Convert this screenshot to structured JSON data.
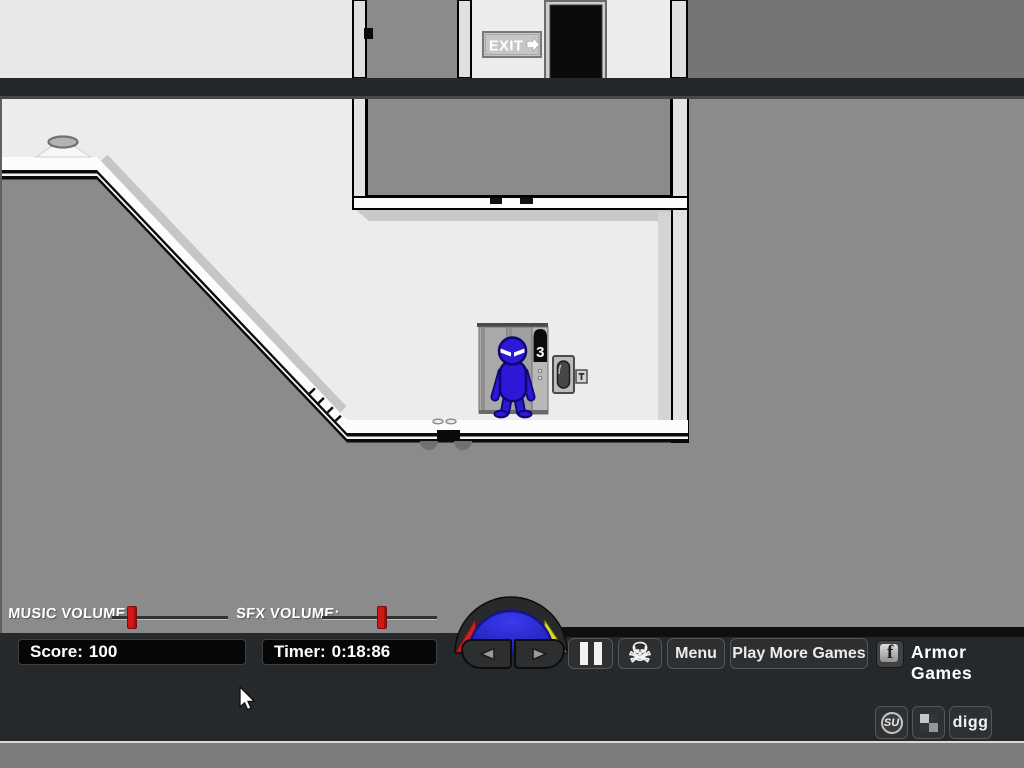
{
  "level": {
    "exit_sign": "EXIT",
    "elevator": {
      "floor_display": "3"
    },
    "colors": {
      "room_white": "#ececec",
      "background_gray": "#8b8b8b",
      "beam_dark": "#25282b",
      "character_blue": "#2c18d6"
    }
  },
  "hud": {
    "music_volume_label": "MUSIC VOLUME:",
    "sfx_volume_label": "SFX VOLUME:",
    "music_volume_percent": 14,
    "sfx_volume_percent": 49,
    "slider_handle_color": "#d21717",
    "score_label": "Score:",
    "score_value": "100",
    "timer_label": "Timer:",
    "timer_value": "0:18:86"
  },
  "controls": {
    "pause_icon": "pause-bars",
    "skull_glyph": "☠",
    "menu_label": "Menu",
    "play_more_games_label": "Play More Games",
    "facebook_glyph": "f",
    "armor_games_label": "Armor Games",
    "dial_colors": {
      "blue": "#2a2ad2",
      "red": "#c92121",
      "yellow": "#ddd829"
    }
  },
  "social": {
    "stumbleupon_label": "SU",
    "delicious_icon": "delicious-checker",
    "digg_label": "digg"
  }
}
